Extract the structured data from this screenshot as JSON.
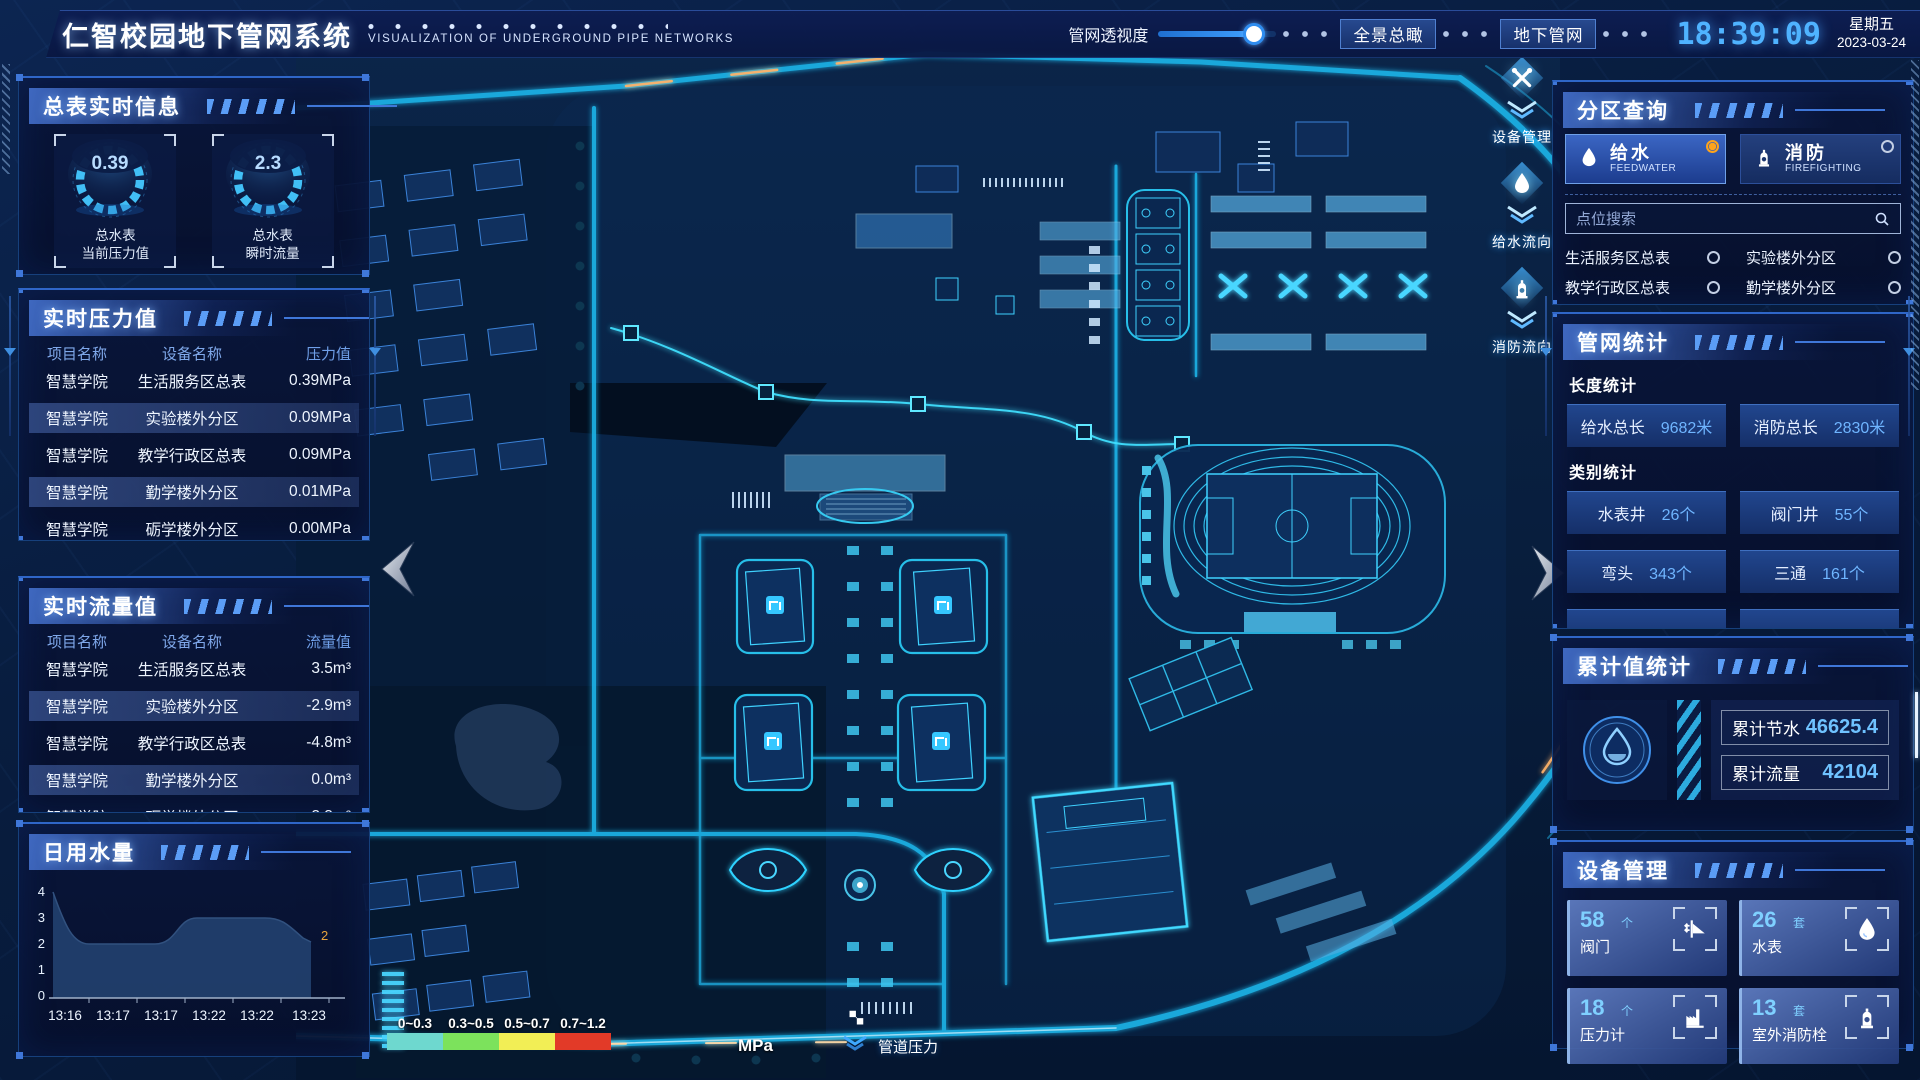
{
  "header": {
    "title": "仁智校园地下管网系统",
    "subtitle": "VISUALIZATION OF UNDERGROUND PIPE NETWORKS",
    "transparency_label": "管网透视度",
    "overview_button": "全景总瞰",
    "underground_button": "地下管网",
    "time": "18:39:09",
    "weekday": "星期五",
    "date": "2023-03-24"
  },
  "left": {
    "master": {
      "title": "总表实时信息",
      "gauges": [
        {
          "value": "0.39",
          "name": "总水表",
          "metric": "当前压力值"
        },
        {
          "value": "2.3",
          "name": "总水表",
          "metric": "瞬时流量"
        }
      ]
    },
    "pressure": {
      "title": "实时压力值",
      "col_project": "项目名称",
      "col_device": "设备名称",
      "col_value": "压力值",
      "rows": [
        {
          "project": "智慧学院",
          "device": "生活服务区总表",
          "value": "0.39MPa"
        },
        {
          "project": "智慧学院",
          "device": "实验楼外分区",
          "value": "0.09MPa"
        },
        {
          "project": "智慧学院",
          "device": "教学行政区总表",
          "value": "0.09MPa"
        },
        {
          "project": "智慧学院",
          "device": "勤学楼外分区",
          "value": "0.01MPa"
        },
        {
          "project": "智慧学院",
          "device": "砺学楼外分区",
          "value": "0.00MPa"
        }
      ]
    },
    "flow": {
      "title": "实时流量值",
      "col_project": "项目名称",
      "col_device": "设备名称",
      "col_value": "流量值",
      "rows": [
        {
          "project": "智慧学院",
          "device": "生活服务区总表",
          "value": "3.5m³"
        },
        {
          "project": "智慧学院",
          "device": "实验楼外分区",
          "value": "-2.9m³"
        },
        {
          "project": "智慧学院",
          "device": "教学行政区总表",
          "value": "-4.8m³"
        },
        {
          "project": "智慧学院",
          "device": "勤学楼外分区",
          "value": "0.0m³"
        },
        {
          "project": "智慧学院",
          "device": "砺学楼外分区",
          "value": "-2.3m³"
        }
      ]
    },
    "daily": {
      "title": "日用水量"
    }
  },
  "chart_data": {
    "type": "area",
    "title": "日用水量",
    "x": [
      "13:16",
      "13:17",
      "13:17",
      "13:22",
      "13:22",
      "13:23"
    ],
    "values": [
      4,
      2,
      2,
      3,
      3,
      2
    ],
    "yticks": [
      "4",
      "3",
      "2",
      "1",
      "0"
    ],
    "ylim": [
      0,
      4
    ],
    "end_point_label": "2",
    "grid": false,
    "area_color": "#22406e",
    "end_label_color": "#e8a33d"
  },
  "right": {
    "zone": {
      "title": "分区查询",
      "tabs": [
        {
          "label": "给水",
          "sub": "FEEDWATER",
          "selected": true
        },
        {
          "label": "消防",
          "sub": "FIREFIGHTING",
          "selected": false
        }
      ],
      "search_placeholder": "点位搜索",
      "items": [
        "生活服务区总表",
        "实验楼外分区",
        "教学行政区总表",
        "勤学楼外分区",
        "砺学楼外分区",
        "宿舍区泵房"
      ]
    },
    "pipe": {
      "title": "管网统计",
      "length_label": "长度统计",
      "length_items": [
        {
          "label": "给水总长",
          "value": "9682米"
        },
        {
          "label": "消防总长",
          "value": "2830米"
        }
      ],
      "category_label": "类别统计",
      "category_items": [
        {
          "label": "水表井",
          "value": "26个"
        },
        {
          "label": "阀门井",
          "value": "55个"
        },
        {
          "label": "弯头",
          "value": "343个"
        },
        {
          "label": "三通",
          "value": "161个"
        }
      ]
    },
    "cumulative": {
      "title": "累计值统计",
      "items": [
        {
          "label": "累计节水",
          "value": "46625.4"
        },
        {
          "label": "累计流量",
          "value": "42104"
        }
      ]
    },
    "devices": {
      "title": "设备管理",
      "cards": [
        {
          "value": "58",
          "unit": "个",
          "label": "阀门"
        },
        {
          "value": "26",
          "unit": "套",
          "label": "水表"
        },
        {
          "value": "18",
          "unit": "个",
          "label": "压力计"
        },
        {
          "value": "13",
          "unit": "套",
          "label": "室外消防栓"
        }
      ]
    }
  },
  "map_ui": {
    "overlays": [
      {
        "label": "设备管理"
      },
      {
        "label": "给水流向"
      },
      {
        "label": "消防流向"
      }
    ],
    "legend": {
      "unit": "MPa",
      "label": "管道压力",
      "ranges": [
        {
          "range": "0~0.3",
          "color": "#6ed8cf"
        },
        {
          "range": "0.3~0.5",
          "color": "#7ce25c"
        },
        {
          "range": "0.5~0.7",
          "color": "#f2ee55"
        },
        {
          "range": "0.7~1.2",
          "color": "#e23a28"
        }
      ]
    }
  },
  "colors": {
    "accent": "#35c7ff",
    "value_blue": "#5fb0ff",
    "radio_selected": "#ffa41b",
    "clock": "#4fb3ff"
  }
}
